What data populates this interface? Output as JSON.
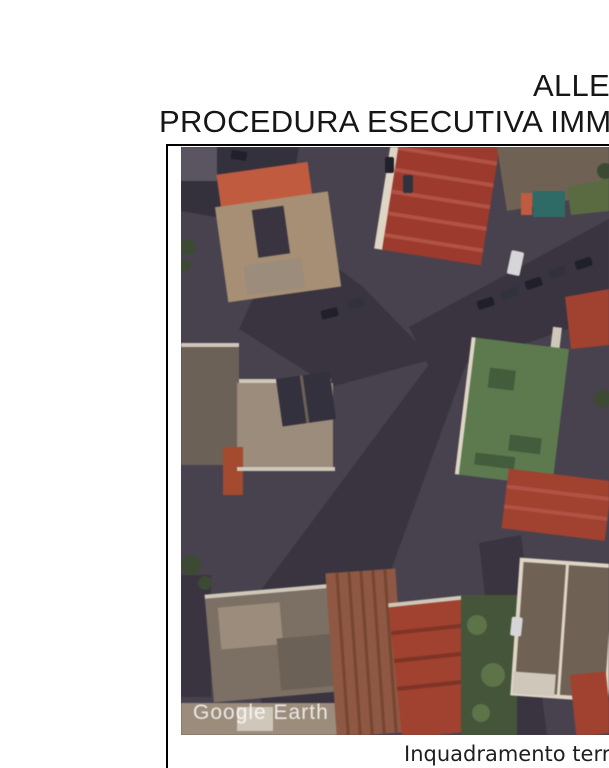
{
  "document": {
    "title_line1": "ALLE",
    "title_line2": "PROCEDURA ESECUTIVA IMM",
    "caption": "Inquadramento terr",
    "text_color": "#161616",
    "border_color": "#000000"
  },
  "map": {
    "watermark": "Google Earth",
    "palette": {
      "asphalt": "#48424e",
      "asphalt-dark": "#393440",
      "block-dark": "#35313c",
      "roof-red": "#9c3a2e",
      "roof-red2": "#a14130",
      "roof-red-light": "#b05244",
      "roof-red-dark": "#7e3426",
      "roof-terracotta": "#8e5844",
      "terracotta-dark": "#77462f",
      "roof-tan": "#a68f74",
      "roof-tan2": "#9b8c7b",
      "roof-orange": "#c05b40",
      "roof-brown": "#6f6255",
      "roof-brown2": "#7c7064",
      "roof-grey": "#6b6157",
      "roof-grey2": "#5a5560",
      "roof-slate": "#33313d",
      "terrace": "#5c7a4e",
      "terrace-dark": "#435c3c",
      "veg": "#45553a",
      "veg2": "#5a6b42",
      "bush": "#5d7348",
      "tarp": "#2e6a66",
      "cream": "#ded5c5",
      "cream2": "#cfc8ba",
      "rust": "#a34a2f",
      "tree": "#3c4a34",
      "car-dark": "#20202a",
      "car-mid": "#32323e",
      "car-white": "#d6d6d8",
      "watermark": "rgba(255,255,255,0.82)"
    }
  }
}
